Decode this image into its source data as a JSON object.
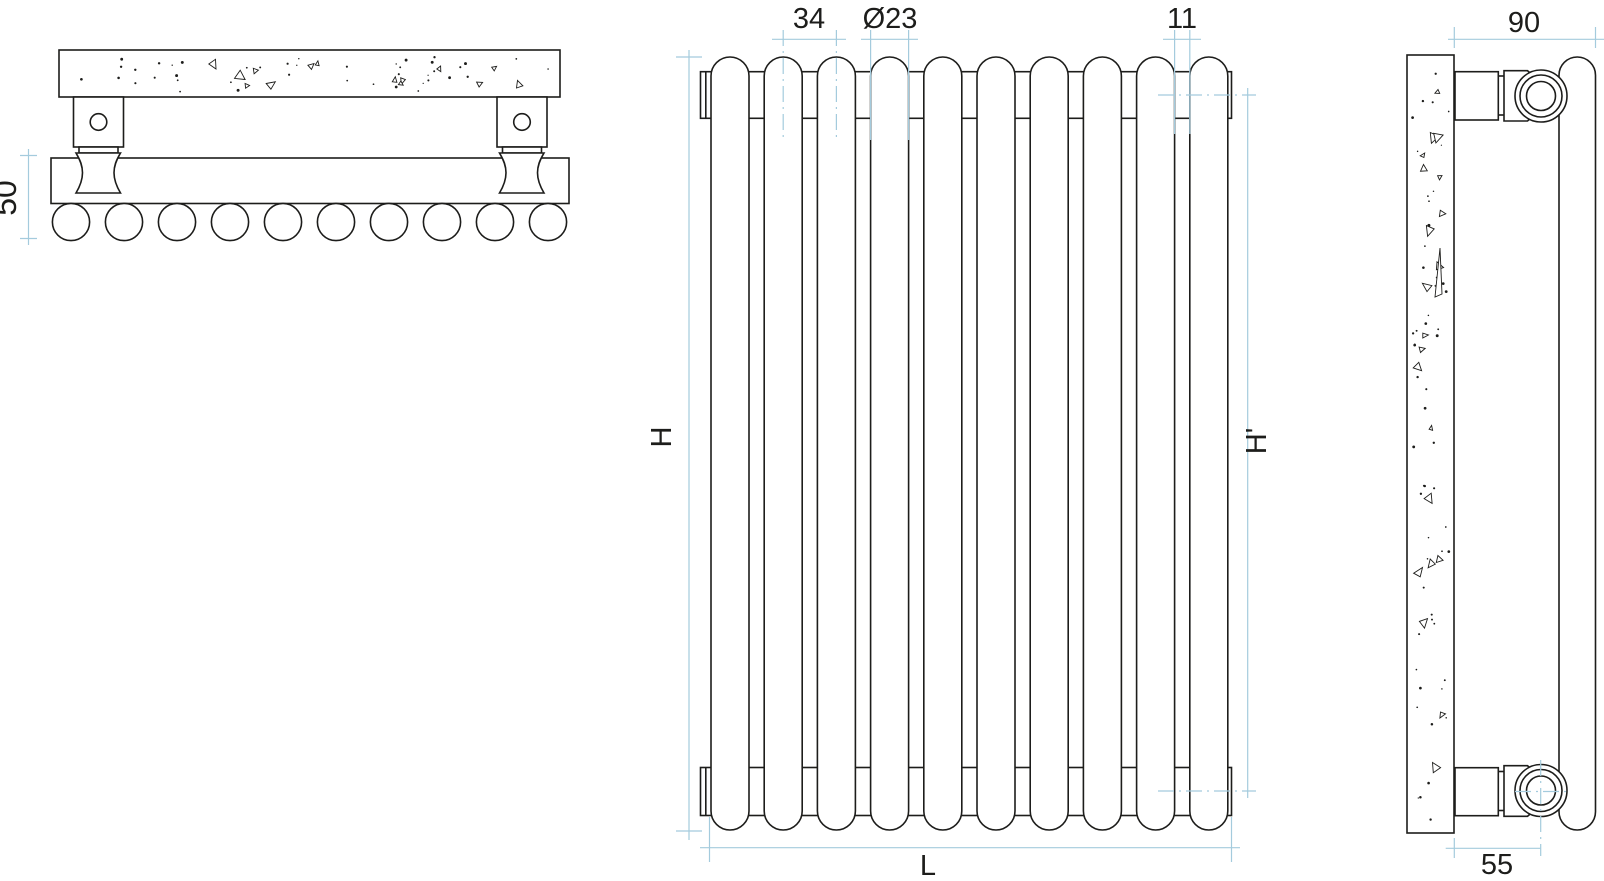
{
  "colors": {
    "background": "#ffffff",
    "line": "#1d1d1b",
    "dimension": "#a4cbdd",
    "text": "#1d1d1b"
  },
  "top_view": {
    "tube_count": 10
  },
  "front_view": {
    "tube_count": 10
  },
  "dimensions": {
    "top_depth": "50",
    "tube_pitch": "34",
    "tube_diameter": "Ø23",
    "tube_gap": "11",
    "height": "H",
    "connection_height": "H'",
    "length": "L",
    "wall_depth": "90",
    "connection_offset": "55"
  }
}
